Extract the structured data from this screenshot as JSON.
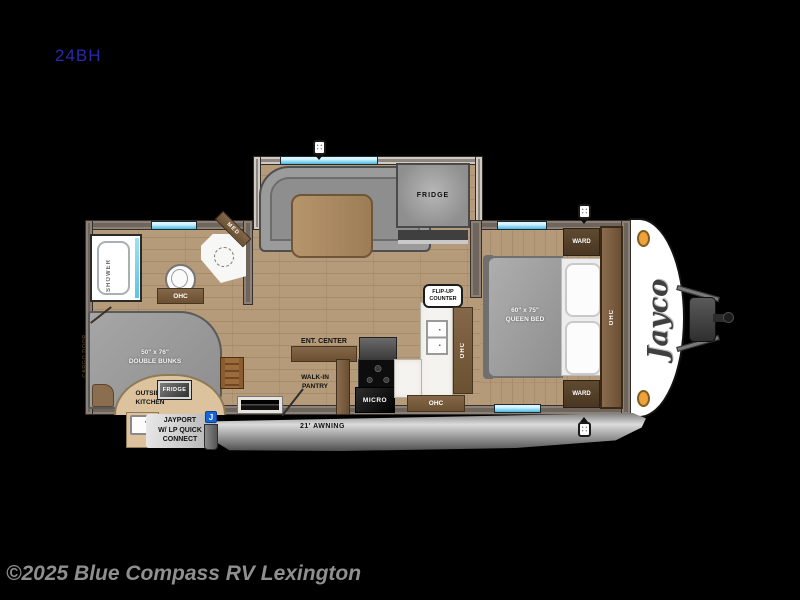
{
  "meta": {
    "model": "24BH",
    "copyright": "©2025 Blue Compass RV Lexington"
  },
  "logo": {
    "brand": "Jayco"
  },
  "exterior": {
    "awning": "21' AWNING",
    "jayport_line1": "JAYPORT",
    "jayport_line2": "W/ LP QUICK",
    "jayport_line3": "CONNECT",
    "jayport_icon": "J",
    "cargo_door": "CARGO DOOR"
  },
  "bathroom": {
    "shower": "SHOWER",
    "med": "MED",
    "ohc": "OHC"
  },
  "bunk_room": {
    "bunks_size": "50\" x 76\"",
    "bunks_label": "DOUBLE BUNKS",
    "outside_kitchen_line1": "OUTSIDE",
    "outside_kitchen_line2": "KITCHEN",
    "fridge": "FRIDGE"
  },
  "dinette": {
    "fridge": "FRIDGE"
  },
  "kitchen": {
    "ent_center": "ENT. CENTER",
    "pantry_line1": "WALK-IN",
    "pantry_line2": "PANTRY",
    "micro": "MICRO",
    "ohc_side": "OHC",
    "ohc_bottom": "OHC",
    "flip_up_line1": "FLIP-UP",
    "flip_up_line2": "COUNTER"
  },
  "bedroom": {
    "bed_size": "60\" x 75\"",
    "bed_label": "QUEEN BED",
    "ward_top": "WARD",
    "ward_bottom": "WARD",
    "ohc": "OHC"
  },
  "colors": {
    "background": "#000000",
    "wall": "#6e655c",
    "wood_floor": "#b29873",
    "window_blue": "#5ec9ec",
    "marker_light_orange": "#f0a23a",
    "jayport_blue": "#1565d8",
    "awning_gray": "#9a9a9a",
    "model_text_blue": "#2a2ab0"
  }
}
